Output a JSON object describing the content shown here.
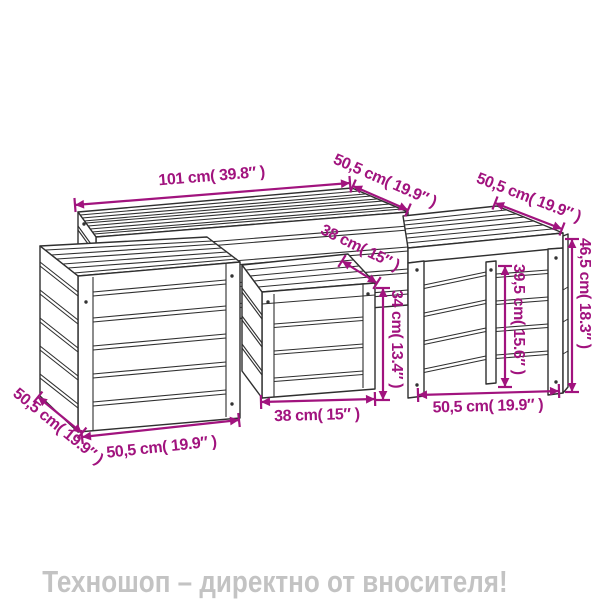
{
  "diagram": {
    "kind": "product-dimension-line-drawing",
    "subject": "garden storage box and bench set (4 pieces)",
    "colors": {
      "background": "#ffffff",
      "line_art": "#2f2f2f",
      "dimension": "#a1137e",
      "footer_text": "#c3c3c3"
    },
    "dimensions": {
      "bench_length": "101 cm( 39.8″ )",
      "bench_depth": "50,5 cm( 19.9″ )",
      "table_depth": "50,5 cm( 19.9″ )",
      "small_box_depth": "38 cm( 15″ )",
      "left_box_depth": "50,5 cm( 19.9″ )",
      "left_box_width": "50,5 cm( 19.9″ )",
      "small_box_width": "38 cm( 15″ )",
      "table_width": "50,5 cm( 19.9″ )",
      "small_box_height": "34 cm( 13.4″ )",
      "table_clearance_height": "39,5 cm( 15.6″ )",
      "table_total_height": "46,5 cm( 18.3″ )"
    }
  },
  "footer": {
    "text": "Техношоп – директно от вносителя!"
  }
}
